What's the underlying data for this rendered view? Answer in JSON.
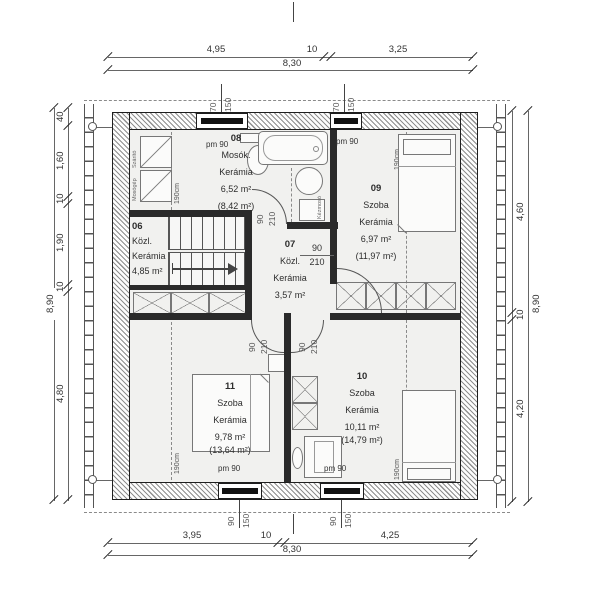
{
  "dimensions": {
    "top": {
      "seg1": "4,95",
      "seg2": "10",
      "seg3": "3,25",
      "total": "8,30"
    },
    "bottom": {
      "seg1": "3,95",
      "seg2": "10",
      "seg3": "4,25",
      "total": "8,30"
    },
    "left": {
      "seg1": "40",
      "seg2": "1,60",
      "seg3": "10",
      "seg4": "1,90",
      "seg5": "10",
      "seg6": "4,80",
      "total": "8,90"
    },
    "right": {
      "seg1": "4,60",
      "seg2": "10",
      "seg3": "4,20",
      "total": "8,90"
    }
  },
  "rooms": {
    "r08": {
      "number": "08",
      "name": "Mosók.",
      "material": "Kerámia",
      "area": "6,52 m²",
      "gross_area": "(8,42 m²)"
    },
    "r06": {
      "number": "06",
      "name": "Közl.",
      "material": "Kerámia",
      "area": "4,85 m²"
    },
    "r07": {
      "number": "07",
      "name": "Közl.",
      "material": "Kerámia",
      "area": "3,57 m²"
    },
    "r09": {
      "number": "09",
      "name": "Szoba",
      "material": "Kerámia",
      "area": "6,97 m²",
      "gross_area": "(11,97 m²)"
    },
    "r10": {
      "number": "10",
      "name": "Szoba",
      "material": "Kerámia",
      "area": "10,11 m²",
      "gross_area": "(14,79 m²)"
    },
    "r11": {
      "number": "11",
      "name": "Szoba",
      "material": "Kerámia",
      "area": "9,78 m²",
      "gross_area": "(13,64 m²)"
    }
  },
  "openings": {
    "door_width": "90",
    "door_height": "210",
    "window_top_width": "70",
    "window_top_height": "150",
    "window_bottom_width": "90",
    "window_bottom_height": "150",
    "parapet": "pm 90"
  },
  "annotations": {
    "headroom": "190cm"
  },
  "fixtures": {
    "dryer": "Szárító",
    "washer": "Mosógép",
    "hand_basin": "Kézmosó"
  },
  "colors": {
    "wall_line": "#1e1e1e",
    "dim_line": "#666666",
    "floor": "#f1f1ef",
    "hatch": "#8f8f8f",
    "text": "#3a3a3a"
  }
}
